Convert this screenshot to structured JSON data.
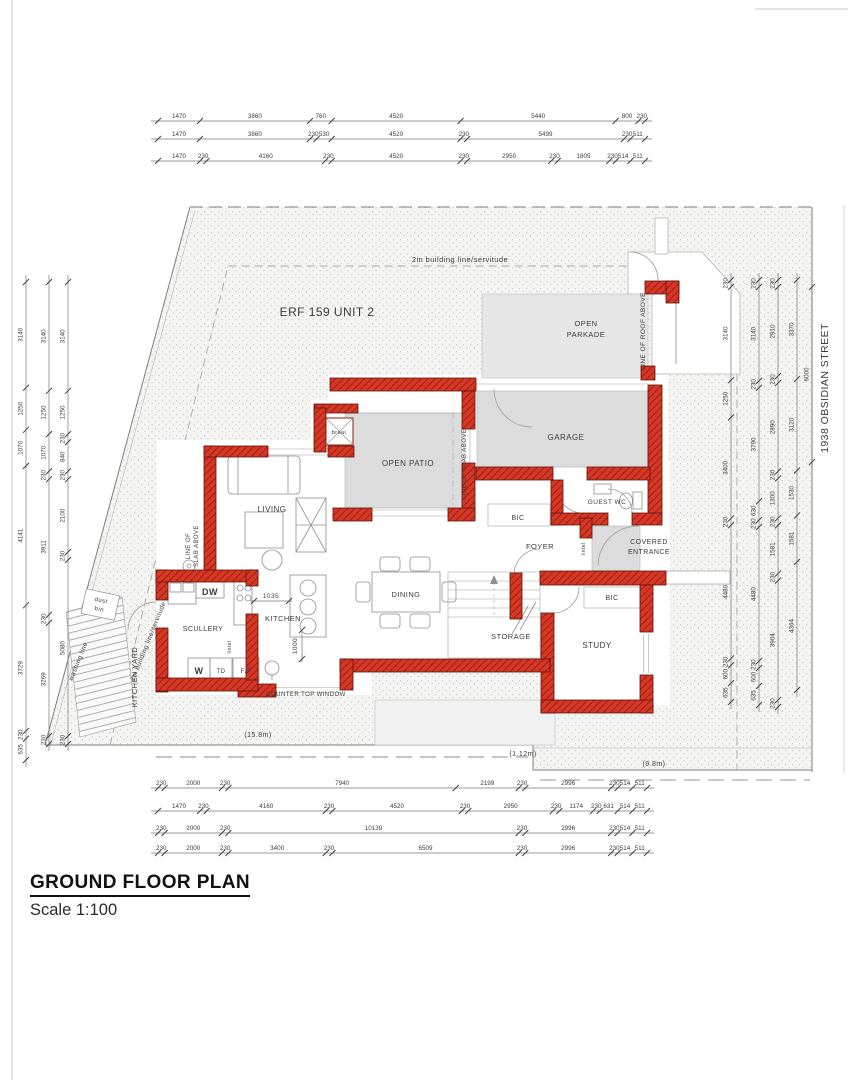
{
  "title": {
    "heading": "GROUND FLOOR PLAN",
    "scale": "Scale 1:100"
  },
  "site": {
    "erf_label": "ERF 159 UNIT 2",
    "building_line_label": "2m building line/servitude",
    "street": "1938 OBSIDIAN STREET",
    "kitchen_yard": "KITCHEN YARD",
    "washing_line": "washing line",
    "dust_bin": [
      "dust",
      "bin"
    ],
    "walk_left": "(15.8m)",
    "walk_mid": "(1.12m)",
    "walk_right": "(9.8m)"
  },
  "rooms": {
    "living": "LIVING",
    "open_patio": "OPEN PATIO",
    "garage": "GARAGE",
    "open_parkade": [
      "OPEN",
      "PARKADE"
    ],
    "guest_wc": "GUEST WC",
    "covered_entrance": [
      "COVERED",
      "ENTRANCE"
    ],
    "foyer": "FOYER",
    "dining": "DINING",
    "kitchen": "KITCHEN",
    "scullery": "SCULLERY",
    "study": "STUDY",
    "storage": "STORAGE",
    "bic": "BIC",
    "braai": "braai"
  },
  "appliances": {
    "dishwasher": "DW",
    "washer": "W",
    "tumble_dryer": "TD",
    "fridge_freezer": "F/F"
  },
  "annotations": {
    "line_of_roof_above": "LINE OF ROOF ABOVE",
    "line_of_slab_above": "LINE OF SLAB ABOVE",
    "line_of_slab_above_2": [
      "LINE OF",
      "SLAB ABOVE"
    ],
    "lintel": "lintel",
    "counter_top_window": "COUNTER TOP WINDOW",
    "dim_1035": "1035",
    "dim_1000": "1000"
  },
  "colors": {
    "wall_red": "#d63726",
    "wall_hatch": "#8c1b0d",
    "slab_gray": "#dcdcdc"
  },
  "dimensions": {
    "top_rows": [
      [
        1470,
        3860,
        760,
        4520,
        5440,
        800,
        230
      ],
      [
        1470,
        3860,
        230,
        530,
        4520,
        230,
        5499,
        230,
        511
      ],
      [
        1470,
        230,
        4160,
        230,
        4520,
        230,
        2950,
        230,
        1805,
        230,
        514,
        511
      ]
    ],
    "bottom_rows": [
      [
        230,
        2000,
        230,
        7940,
        2199,
        230,
        2996,
        230,
        514,
        511
      ],
      [
        1470,
        230,
        4160,
        230,
        4520,
        230,
        2950,
        230,
        1174,
        230,
        631,
        514,
        511
      ],
      [
        230,
        2000,
        230,
        10139,
        230,
        2996,
        230,
        514,
        511
      ],
      [
        230,
        2000,
        230,
        3400,
        230,
        6509,
        230,
        2996,
        230,
        514,
        511
      ]
    ],
    "left_cols": [
      [
        3140,
        1250,
        1070,
        4141,
        3729,
        230,
        635
      ],
      [
        3140,
        1250,
        1070,
        230,
        3911,
        230,
        3269,
        230
      ],
      [
        3140,
        1250,
        230,
        840,
        230,
        2100,
        230,
        5080,
        230
      ]
    ],
    "right_cols": [
      [
        230,
        3140,
        1250,
        3400,
        230,
        4480,
        230,
        600,
        635
      ],
      [
        230,
        3140,
        230,
        3790,
        630,
        230,
        4480,
        230,
        600,
        635
      ],
      [
        230,
        2910,
        230,
        2890,
        230,
        1300,
        230,
        1581,
        230,
        3904,
        230
      ],
      [
        3370,
        3120,
        1530,
        1581,
        4364
      ]
    ],
    "street_depth": [
      6000
    ]
  }
}
